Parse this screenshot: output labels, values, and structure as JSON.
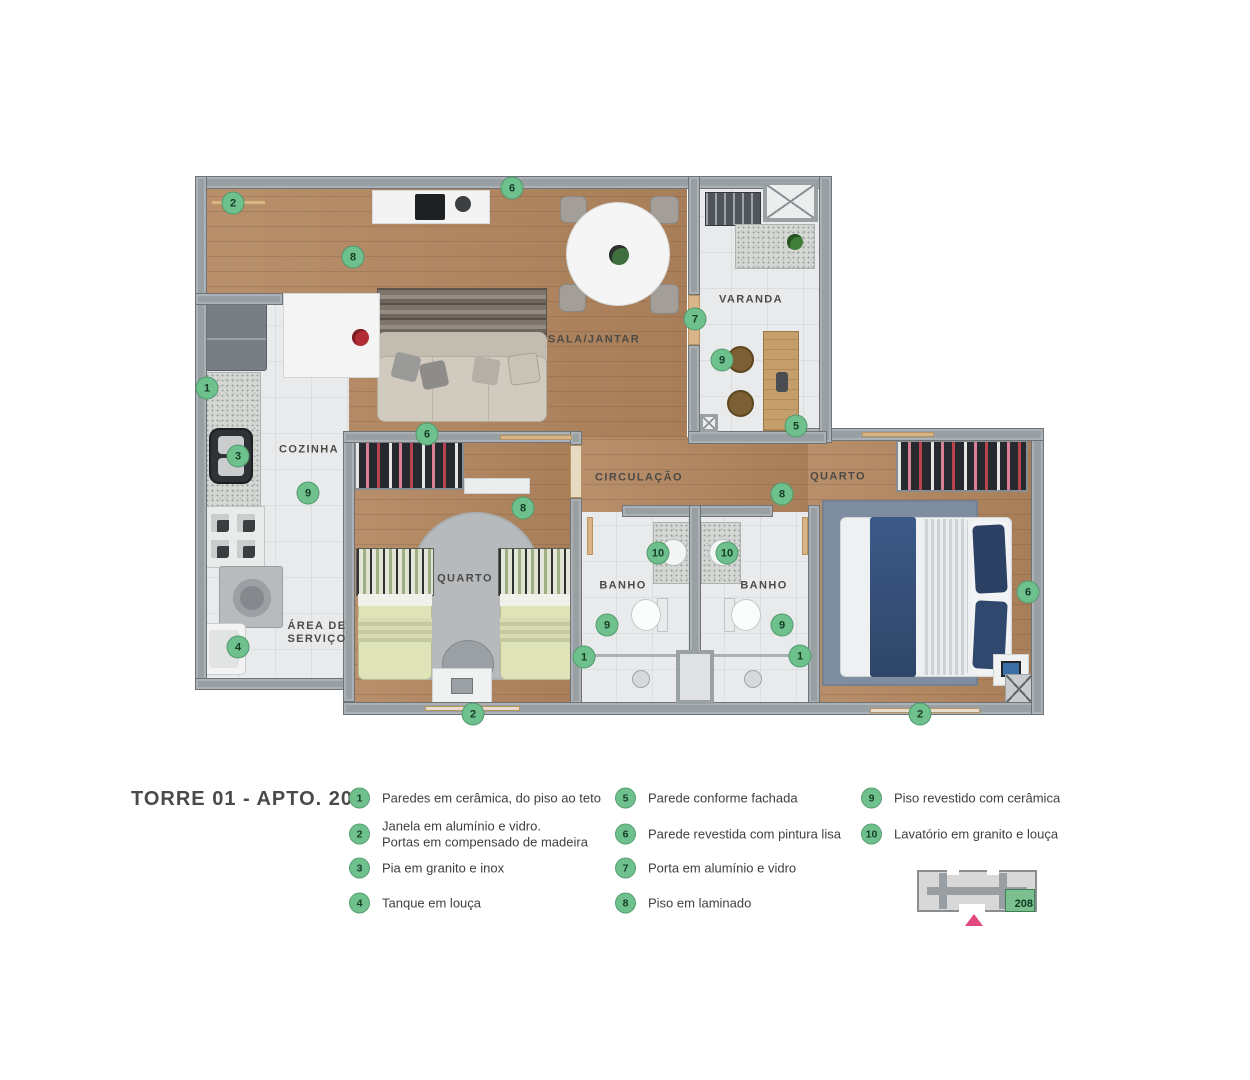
{
  "title": "TORRE 01 - APTO. 208",
  "plan": {
    "room_labels": [
      {
        "text": "SALA/JANTAR",
        "x": 594,
        "y": 340
      },
      {
        "text": "VARANDA",
        "x": 751,
        "y": 300
      },
      {
        "text": "COZINHA",
        "x": 309,
        "y": 450
      },
      {
        "text": "ÁREA DE\nSERVIÇO",
        "x": 317,
        "y": 633
      },
      {
        "text": "CIRCULAÇÃO",
        "x": 639,
        "y": 478
      },
      {
        "text": "QUARTO",
        "x": 465,
        "y": 579
      },
      {
        "text": "QUARTO",
        "x": 838,
        "y": 477
      },
      {
        "text": "BANHO",
        "x": 623,
        "y": 586
      },
      {
        "text": "BANHO",
        "x": 764,
        "y": 586
      }
    ],
    "markers": [
      {
        "num": "2",
        "x": 233,
        "y": 203
      },
      {
        "num": "6",
        "x": 512,
        "y": 188
      },
      {
        "num": "8",
        "x": 353,
        "y": 257
      },
      {
        "num": "1",
        "x": 207,
        "y": 388
      },
      {
        "num": "3",
        "x": 238,
        "y": 456
      },
      {
        "num": "9",
        "x": 308,
        "y": 493
      },
      {
        "num": "4",
        "x": 238,
        "y": 647
      },
      {
        "num": "7",
        "x": 695,
        "y": 319
      },
      {
        "num": "9",
        "x": 722,
        "y": 360
      },
      {
        "num": "5",
        "x": 796,
        "y": 426
      },
      {
        "num": "6",
        "x": 427,
        "y": 434
      },
      {
        "num": "8",
        "x": 523,
        "y": 508
      },
      {
        "num": "8",
        "x": 782,
        "y": 494
      },
      {
        "num": "10",
        "x": 658,
        "y": 553
      },
      {
        "num": "10",
        "x": 727,
        "y": 553
      },
      {
        "num": "9",
        "x": 607,
        "y": 625
      },
      {
        "num": "9",
        "x": 782,
        "y": 625
      },
      {
        "num": "1",
        "x": 584,
        "y": 657
      },
      {
        "num": "1",
        "x": 800,
        "y": 656
      },
      {
        "num": "2",
        "x": 473,
        "y": 714
      },
      {
        "num": "2",
        "x": 920,
        "y": 714
      },
      {
        "num": "6",
        "x": 1028,
        "y": 592
      }
    ]
  },
  "legend": {
    "columns": [
      [
        {
          "num": "1",
          "text": "Paredes em cerâmica, do piso ao teto"
        },
        {
          "num": "2",
          "text": "Janela em alumínio e vidro.\nPortas em compensado de madeira"
        },
        {
          "num": "3",
          "text": "Pia em granito e inox"
        },
        {
          "num": "4",
          "text": "Tanque em louça"
        }
      ],
      [
        {
          "num": "5",
          "text": "Parede conforme fachada"
        },
        {
          "num": "6",
          "text": "Parede revestida com pintura lisa"
        },
        {
          "num": "7",
          "text": "Porta em alumínio e vidro"
        },
        {
          "num": "8",
          "text": "Piso em laminado"
        }
      ],
      [
        {
          "num": "9",
          "text": "Piso revestido com cerâmica"
        },
        {
          "num": "10",
          "text": "Lavatório em granito e louça"
        }
      ]
    ]
  },
  "keyplan": {
    "unit": "208"
  },
  "colors": {
    "accent_green": "#6ec08d",
    "keyplan_unit_green": "#7cc08f",
    "keyplan_arrow_pink": "#e0487f",
    "wood_floor": "#b2865e",
    "wall_gray": "#99a0a4"
  }
}
